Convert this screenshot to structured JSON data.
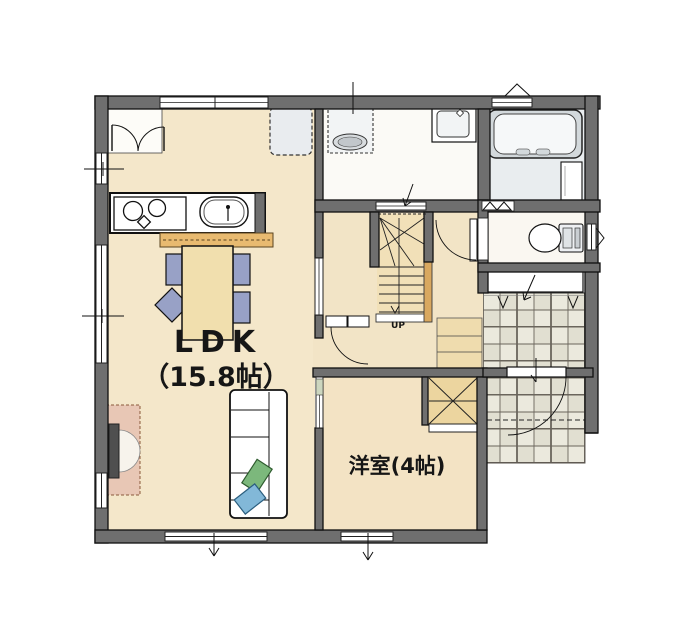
{
  "labels": {
    "ldk": "LDK",
    "ldk_size": "（15.8帖）",
    "western_room": "洋室(4帖)",
    "stairs_up": "UP"
  },
  "rooms": [
    {
      "name": "LDK",
      "size": "15.8帖"
    },
    {
      "name": "洋室",
      "size": "4帖"
    }
  ],
  "fixtures": [
    "kitchen-counter",
    "gas-stove",
    "kitchen-sink",
    "breakfast-bar",
    "refrigerator-space",
    "closet-double-door",
    "dining-table",
    "dining-chairs",
    "sofa",
    "cushions",
    "tv-board",
    "washing-machine-pan",
    "vanity-basin",
    "bathtub",
    "bath-counter",
    "folding-bath-door",
    "toilet",
    "staircase",
    "stair-handrail",
    "under-stair-steps",
    "shoe-cabinet",
    "western-room-closet",
    "sliding-doors",
    "entrance-door",
    "entrance-tiles",
    "porch-tiles",
    "windows"
  ],
  "palette": {
    "wall": "#6f6f6f",
    "outline": "#111111",
    "wood_floor": "#f4e7ca",
    "wood_floor_alt": "#f3e3c4",
    "stair": "#f1e0b8",
    "handrail": "#d9a85f",
    "counter_bar": "#e8ba70",
    "chair_blue": "#98a1c6",
    "cushion_green": "#7cb87c",
    "cushion_blue": "#82b8d8",
    "tv_board": "#e8c7b5",
    "tile": "#ebe9dd",
    "bath_floor": "#e9edef",
    "washroom_floor": "#fbfaf6",
    "toilet_floor": "#faf7f1"
  }
}
